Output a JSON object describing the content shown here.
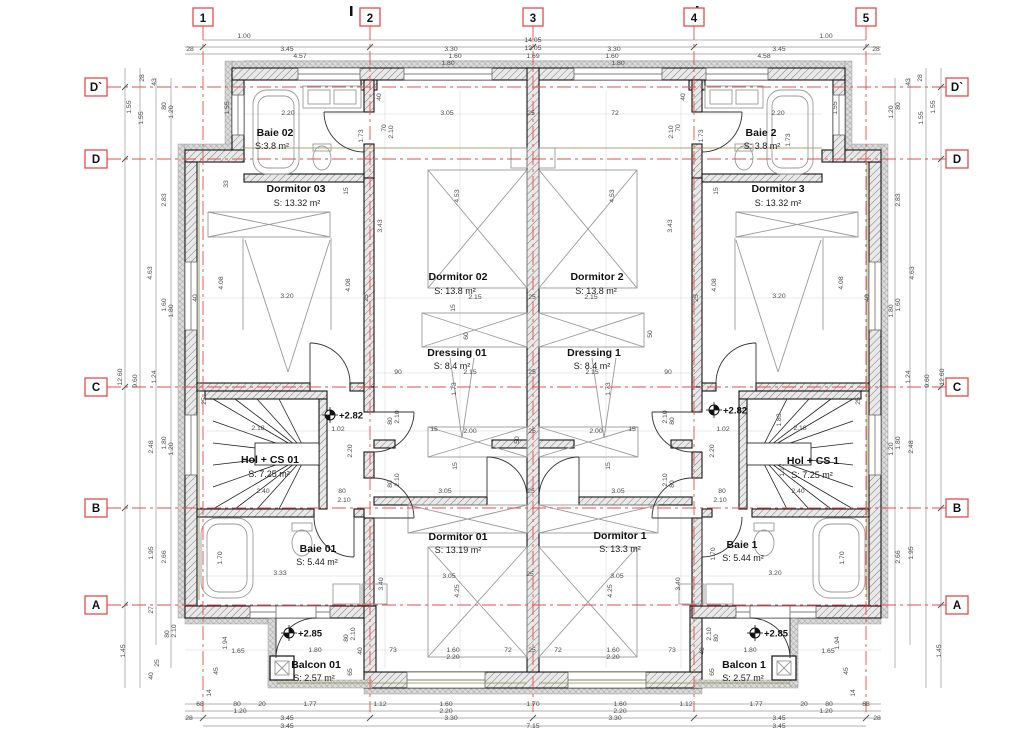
{
  "drawing": {
    "type": "floor-plan",
    "units": "m"
  },
  "colors": {
    "grid_red": "#e64c4c",
    "wall": "#141414",
    "dim_text": "#4a4a4a",
    "olive_line": "#8d8d3a"
  },
  "grid": {
    "cols": [
      {
        "label": "1",
        "x": 203
      },
      {
        "label": "2",
        "x": 370
      },
      {
        "label": "3",
        "x": 533
      },
      {
        "label": "4",
        "x": 694
      },
      {
        "label": "5",
        "x": 866
      }
    ],
    "rows": [
      {
        "label": "D`",
        "y": 87
      },
      {
        "label": "D",
        "y": 159
      },
      {
        "label": "C",
        "y": 387
      },
      {
        "label": "B",
        "y": 508
      },
      {
        "label": "A",
        "y": 605
      }
    ]
  },
  "rooms": [
    {
      "name": "Baie 02",
      "area": "S:3.8 m²",
      "nx": 275,
      "ny": 136,
      "ax": 272,
      "ay": 149
    },
    {
      "name": "Dormitor 03",
      "area": "S: 13.32 m²",
      "nx": 296,
      "ny": 192,
      "ax": 297,
      "ay": 206
    },
    {
      "name": "Baie 2",
      "area": "S: 3.8 m²",
      "nx": 761,
      "ny": 136,
      "ax": 762,
      "ay": 149
    },
    {
      "name": "Dormitor 3",
      "area": "S: 13.32 m²",
      "nx": 778,
      "ny": 192,
      "ax": 778,
      "ay": 206
    },
    {
      "name": "Dormitor 02",
      "area": "S: 13.8 m²",
      "nx": 458,
      "ny": 280,
      "ax": 455,
      "ay": 294
    },
    {
      "name": "Dormitor 2",
      "area": "S: 13.8 m²",
      "nx": 597,
      "ny": 280,
      "ax": 596,
      "ay": 294
    },
    {
      "name": "Dressing 01",
      "area": "S: 8.4 m²",
      "nx": 457,
      "ny": 356,
      "ax": 452,
      "ay": 369
    },
    {
      "name": "Dressing 1",
      "area": "S: 8.4 m²",
      "nx": 594,
      "ny": 356,
      "ax": 592,
      "ay": 369
    },
    {
      "name": "Hol + CS 01",
      "area": "S: 7.25 m²",
      "nx": 270,
      "ny": 463,
      "ax": 269,
      "ay": 477
    },
    {
      "name": "Hol + CS 1",
      "area": "S: 7.25 m²",
      "nx": 813,
      "ny": 464,
      "ax": 812,
      "ay": 478
    },
    {
      "name": "Baie 01",
      "area": "S: 5.44 m²",
      "nx": 318,
      "ny": 552,
      "ax": 317,
      "ay": 565
    },
    {
      "name": "Baie 1",
      "area": "S: 5.44 m²",
      "nx": 742,
      "ny": 548,
      "ax": 743,
      "ay": 561
    },
    {
      "name": "Dormitor 01",
      "area": "S: 13.19 m²",
      "nx": 458,
      "ny": 540,
      "ax": 458,
      "ay": 553
    },
    {
      "name": "Dormitor 1",
      "area": "S: 13.3 m²",
      "nx": 620,
      "ny": 539,
      "ax": 620,
      "ay": 552
    },
    {
      "name": "Balcon 01",
      "area": "S: 2.57 m²",
      "nx": 316,
      "ny": 668,
      "ax": 314,
      "ay": 681
    },
    {
      "name": "Balcon 1",
      "area": "S: 2.57 m²",
      "nx": 744,
      "ny": 668,
      "ax": 743,
      "ay": 681
    }
  ],
  "elevations": [
    {
      "label": "+2.82",
      "x": 330,
      "y": 415
    },
    {
      "label": "+2.82",
      "x": 714,
      "y": 410
    },
    {
      "label": "+2.85",
      "x": 289,
      "y": 633
    },
    {
      "label": "+2.85",
      "x": 755,
      "y": 633
    }
  ],
  "dims": [
    {
      "t": "14.05",
      "x": 533,
      "y": 42
    },
    {
      "t": "12.05",
      "x": 533,
      "y": 50
    },
    {
      "t": "1.00",
      "x": 244,
      "y": 38
    },
    {
      "t": "1.00",
      "x": 826,
      "y": 38
    },
    {
      "t": "28",
      "x": 190,
      "y": 51
    },
    {
      "t": "3.45",
      "x": 287,
      "y": 51
    },
    {
      "t": "3.30",
      "x": 451,
      "y": 51
    },
    {
      "t": "3.30",
      "x": 614,
      "y": 51
    },
    {
      "t": "3.45",
      "x": 779,
      "y": 51
    },
    {
      "t": "28",
      "x": 876,
      "y": 51
    },
    {
      "t": "4.57",
      "x": 300,
      "y": 58
    },
    {
      "t": "1.60",
      "x": 455,
      "y": 58
    },
    {
      "t": "1.69",
      "x": 533,
      "y": 58
    },
    {
      "t": "1.60",
      "x": 612,
      "y": 58
    },
    {
      "t": "4.58",
      "x": 764,
      "y": 58
    },
    {
      "t": "1.80",
      "x": 448,
      "y": 65
    },
    {
      "t": "1.80",
      "x": 618,
      "y": 65
    },
    {
      "t": "28",
      "x": 144,
      "y": 78,
      "r": 1
    },
    {
      "t": "43",
      "x": 156,
      "y": 82,
      "r": 1
    },
    {
      "t": "1.55",
      "x": 131,
      "y": 107,
      "r": 1
    },
    {
      "t": "1.55",
      "x": 143,
      "y": 118,
      "r": 1
    },
    {
      "t": "80",
      "x": 166,
      "y": 106,
      "r": 1
    },
    {
      "t": "1.20",
      "x": 173,
      "y": 112,
      "r": 1
    },
    {
      "t": "1.55",
      "x": 229,
      "y": 108,
      "r": 1
    },
    {
      "t": "33",
      "x": 228,
      "y": 184,
      "r": 1
    },
    {
      "t": "2.83",
      "x": 166,
      "y": 200,
      "r": 1
    },
    {
      "t": "4.63",
      "x": 152,
      "y": 273,
      "r": 1
    },
    {
      "t": "1.60",
      "x": 166,
      "y": 305,
      "r": 1
    },
    {
      "t": "1.80",
      "x": 173,
      "y": 311,
      "r": 1
    },
    {
      "t": "4.08",
      "x": 223,
      "y": 283,
      "r": 1
    },
    {
      "t": "4.08",
      "x": 350,
      "y": 285,
      "r": 1
    },
    {
      "t": "40",
      "x": 197,
      "y": 298,
      "r": 1
    },
    {
      "t": "25",
      "x": 368,
      "y": 298,
      "r": 1
    },
    {
      "t": "1.24",
      "x": 156,
      "y": 377,
      "r": 1
    },
    {
      "t": "9.60",
      "x": 137,
      "y": 381,
      "r": 1
    },
    {
      "t": "12.60",
      "x": 122,
      "y": 377,
      "r": 1
    },
    {
      "t": "2.48",
      "x": 153,
      "y": 447,
      "r": 1
    },
    {
      "t": "1.80",
      "x": 166,
      "y": 443,
      "r": 1
    },
    {
      "t": "1.20",
      "x": 173,
      "y": 449,
      "r": 1
    },
    {
      "t": "1.95",
      "x": 153,
      "y": 553,
      "r": 1
    },
    {
      "t": "2.66",
      "x": 166,
      "y": 557,
      "r": 1
    },
    {
      "t": "27",
      "x": 153,
      "y": 610,
      "r": 1
    },
    {
      "t": "80",
      "x": 169,
      "y": 634,
      "r": 1
    },
    {
      "t": "2.10",
      "x": 176,
      "y": 631,
      "r": 1
    },
    {
      "t": "1.45",
      "x": 125,
      "y": 651,
      "r": 1
    },
    {
      "t": "40",
      "x": 153,
      "y": 676,
      "r": 1
    },
    {
      "t": "25",
      "x": 159,
      "y": 663,
      "r": 1
    },
    {
      "t": "1.94",
      "x": 227,
      "y": 643,
      "r": 1
    },
    {
      "t": "1.65",
      "x": 238,
      "y": 653
    },
    {
      "t": "45",
      "x": 218,
      "y": 671,
      "r": 1
    },
    {
      "t": "14",
      "x": 211,
      "y": 693,
      "r": 1
    },
    {
      "t": "28",
      "x": 922,
      "y": 78,
      "r": 1
    },
    {
      "t": "43",
      "x": 910,
      "y": 82,
      "r": 1
    },
    {
      "t": "1.55",
      "x": 935,
      "y": 107,
      "r": 1
    },
    {
      "t": "1.55",
      "x": 923,
      "y": 118,
      "r": 1
    },
    {
      "t": "80",
      "x": 900,
      "y": 106,
      "r": 1
    },
    {
      "t": "1.20",
      "x": 893,
      "y": 112,
      "r": 1
    },
    {
      "t": "1.55",
      "x": 837,
      "y": 108,
      "r": 1
    },
    {
      "t": "2.83",
      "x": 900,
      "y": 200,
      "r": 1
    },
    {
      "t": "4.63",
      "x": 914,
      "y": 273,
      "r": 1
    },
    {
      "t": "1.60",
      "x": 900,
      "y": 305,
      "r": 1
    },
    {
      "t": "1.80",
      "x": 893,
      "y": 311,
      "r": 1
    },
    {
      "t": "4.08",
      "x": 843,
      "y": 283,
      "r": 1
    },
    {
      "t": "4.08",
      "x": 716,
      "y": 285,
      "r": 1
    },
    {
      "t": "40",
      "x": 869,
      "y": 298,
      "r": 1
    },
    {
      "t": "25",
      "x": 698,
      "y": 298,
      "r": 1
    },
    {
      "t": "1.24",
      "x": 910,
      "y": 377,
      "r": 1
    },
    {
      "t": "9.60",
      "x": 929,
      "y": 381,
      "r": 1
    },
    {
      "t": "12.60",
      "x": 944,
      "y": 377,
      "r": 1
    },
    {
      "t": "2.48",
      "x": 913,
      "y": 447,
      "r": 1
    },
    {
      "t": "1.80",
      "x": 900,
      "y": 443,
      "r": 1
    },
    {
      "t": "1.20",
      "x": 893,
      "y": 449,
      "r": 1
    },
    {
      "t": "1.95",
      "x": 913,
      "y": 553,
      "r": 1
    },
    {
      "t": "2.66",
      "x": 900,
      "y": 557,
      "r": 1
    },
    {
      "t": "1.45",
      "x": 941,
      "y": 651,
      "r": 1
    },
    {
      "t": "1.94",
      "x": 839,
      "y": 643,
      "r": 1
    },
    {
      "t": "1.65",
      "x": 828,
      "y": 653
    },
    {
      "t": "45",
      "x": 848,
      "y": 671,
      "r": 1
    },
    {
      "t": "14",
      "x": 855,
      "y": 693,
      "r": 1
    },
    {
      "t": "68",
      "x": 200,
      "y": 706
    },
    {
      "t": "80",
      "x": 237,
      "y": 706
    },
    {
      "t": "1.20",
      "x": 240,
      "y": 713
    },
    {
      "t": "20",
      "x": 262,
      "y": 706
    },
    {
      "t": "1.77",
      "x": 310,
      "y": 706
    },
    {
      "t": "1.12",
      "x": 380,
      "y": 706
    },
    {
      "t": "1.60",
      "x": 446,
      "y": 706
    },
    {
      "t": "2.20",
      "x": 446,
      "y": 713
    },
    {
      "t": "1.70",
      "x": 533,
      "y": 706
    },
    {
      "t": "1.60",
      "x": 620,
      "y": 706
    },
    {
      "t": "2.20",
      "x": 620,
      "y": 713
    },
    {
      "t": "1.12",
      "x": 686,
      "y": 706
    },
    {
      "t": "1.77",
      "x": 756,
      "y": 706
    },
    {
      "t": "20",
      "x": 804,
      "y": 706
    },
    {
      "t": "80",
      "x": 829,
      "y": 706
    },
    {
      "t": "1.20",
      "x": 826,
      "y": 713
    },
    {
      "t": "68",
      "x": 866,
      "y": 706
    },
    {
      "t": "28",
      "x": 189,
      "y": 720
    },
    {
      "t": "3.45",
      "x": 287,
      "y": 720
    },
    {
      "t": "3.30",
      "x": 451,
      "y": 720
    },
    {
      "t": "3.30",
      "x": 615,
      "y": 720
    },
    {
      "t": "3.45",
      "x": 779,
      "y": 720
    },
    {
      "t": "28",
      "x": 877,
      "y": 720
    },
    {
      "t": "3.45",
      "x": 287,
      "y": 728
    },
    {
      "t": "7.15",
      "x": 533,
      "y": 728
    },
    {
      "t": "3.45",
      "x": 779,
      "y": 728
    },
    {
      "t": "2.20",
      "x": 288,
      "y": 115
    },
    {
      "t": "1.73",
      "x": 363,
      "y": 136,
      "r": 1
    },
    {
      "t": "40",
      "x": 381,
      "y": 97,
      "r": 1
    },
    {
      "t": "70",
      "x": 386,
      "y": 128,
      "r": 1
    },
    {
      "t": "2.10",
      "x": 393,
      "y": 132,
      "r": 1
    },
    {
      "t": "3.05",
      "x": 447,
      "y": 115
    },
    {
      "t": "25",
      "x": 531,
      "y": 115
    },
    {
      "t": "72",
      "x": 615,
      "y": 115
    },
    {
      "t": "70",
      "x": 680,
      "y": 128,
      "r": 1
    },
    {
      "t": "2.10",
      "x": 673,
      "y": 132,
      "r": 1
    },
    {
      "t": "40",
      "x": 685,
      "y": 97,
      "r": 1
    },
    {
      "t": "2.20",
      "x": 778,
      "y": 115
    },
    {
      "t": "1.73",
      "x": 703,
      "y": 136,
      "r": 1
    },
    {
      "t": "1.73",
      "x": 790,
      "y": 140,
      "r": 1
    },
    {
      "t": "15",
      "x": 348,
      "y": 191,
      "r": 1
    },
    {
      "t": "15",
      "x": 718,
      "y": 191,
      "r": 1
    },
    {
      "t": "4.53",
      "x": 459,
      "y": 196,
      "r": 1
    },
    {
      "t": "4.53",
      "x": 614,
      "y": 196,
      "r": 1
    },
    {
      "t": "3.43",
      "x": 382,
      "y": 226,
      "r": 1
    },
    {
      "t": "3.43",
      "x": 672,
      "y": 226,
      "r": 1
    },
    {
      "t": "3.20",
      "x": 287,
      "y": 298
    },
    {
      "t": "3.20",
      "x": 779,
      "y": 298
    },
    {
      "t": "2.15",
      "x": 475,
      "y": 299
    },
    {
      "t": "25",
      "x": 532,
      "y": 299
    },
    {
      "t": "2.15",
      "x": 591,
      "y": 299
    },
    {
      "t": "15",
      "x": 455,
      "y": 308,
      "r": 1
    },
    {
      "t": "60",
      "x": 468,
      "y": 336,
      "r": 1
    },
    {
      "t": "50",
      "x": 652,
      "y": 334,
      "r": 1
    },
    {
      "t": "90",
      "x": 398,
      "y": 374
    },
    {
      "t": "2.15",
      "x": 470,
      "y": 374
    },
    {
      "t": "25",
      "x": 532,
      "y": 374
    },
    {
      "t": "2.15",
      "x": 592,
      "y": 374
    },
    {
      "t": "90",
      "x": 668,
      "y": 374
    },
    {
      "t": "1.73",
      "x": 456,
      "y": 389,
      "r": 1
    },
    {
      "t": "1.73",
      "x": 610,
      "y": 389,
      "r": 1
    },
    {
      "t": "15",
      "x": 434,
      "y": 431
    },
    {
      "t": "2.00",
      "x": 470,
      "y": 433
    },
    {
      "t": "25",
      "x": 532,
      "y": 433
    },
    {
      "t": "2.00",
      "x": 596,
      "y": 433
    },
    {
      "t": "15",
      "x": 632,
      "y": 431
    },
    {
      "t": "50",
      "x": 519,
      "y": 440,
      "r": 1
    },
    {
      "t": "15",
      "x": 457,
      "y": 466,
      "r": 1
    },
    {
      "t": "15",
      "x": 610,
      "y": 466,
      "r": 1
    },
    {
      "t": "2.18",
      "x": 258,
      "y": 430
    },
    {
      "t": "1.02",
      "x": 338,
      "y": 431
    },
    {
      "t": "2.20",
      "x": 352,
      "y": 451,
      "r": 1
    },
    {
      "t": "2.40",
      "x": 263,
      "y": 493
    },
    {
      "t": "80",
      "x": 342,
      "y": 493
    },
    {
      "t": "2.10",
      "x": 344,
      "y": 502
    },
    {
      "t": "2.18",
      "x": 800,
      "y": 430
    },
    {
      "t": "1.02",
      "x": 723,
      "y": 431
    },
    {
      "t": "2.20",
      "x": 714,
      "y": 451,
      "r": 1
    },
    {
      "t": "1.83",
      "x": 781,
      "y": 420,
      "r": 1
    },
    {
      "t": "1.17",
      "x": 784,
      "y": 470,
      "r": 1
    },
    {
      "t": "2.40",
      "x": 798,
      "y": 493
    },
    {
      "t": "80",
      "x": 722,
      "y": 493
    },
    {
      "t": "2.10",
      "x": 720,
      "y": 502
    },
    {
      "t": "80",
      "x": 392,
      "y": 421,
      "r": 1
    },
    {
      "t": "2.10",
      "x": 399,
      "y": 417,
      "r": 1
    },
    {
      "t": "80",
      "x": 392,
      "y": 484,
      "r": 1
    },
    {
      "t": "2.10",
      "x": 399,
      "y": 480,
      "r": 1
    },
    {
      "t": "80",
      "x": 674,
      "y": 421,
      "r": 1
    },
    {
      "t": "2.10",
      "x": 667,
      "y": 417,
      "r": 1
    },
    {
      "t": "80",
      "x": 674,
      "y": 484,
      "r": 1
    },
    {
      "t": "2.10",
      "x": 667,
      "y": 480,
      "r": 1
    },
    {
      "t": "25",
      "x": 206,
      "y": 401,
      "r": 1
    },
    {
      "t": "25",
      "x": 860,
      "y": 401,
      "r": 1
    },
    {
      "t": "3.05",
      "x": 445,
      "y": 493
    },
    {
      "t": "25",
      "x": 531,
      "y": 493
    },
    {
      "t": "3.05",
      "x": 618,
      "y": 493
    },
    {
      "t": "3.05",
      "x": 449,
      "y": 578
    },
    {
      "t": "25",
      "x": 530,
      "y": 576
    },
    {
      "t": "3.05",
      "x": 617,
      "y": 578
    },
    {
      "t": "4.25",
      "x": 459,
      "y": 591,
      "r": 1
    },
    {
      "t": "4.25",
      "x": 612,
      "y": 591,
      "r": 1
    },
    {
      "t": "3.40",
      "x": 383,
      "y": 584,
      "r": 1
    },
    {
      "t": "3.40",
      "x": 680,
      "y": 584,
      "r": 1
    },
    {
      "t": "1.70",
      "x": 222,
      "y": 558,
      "r": 1
    },
    {
      "t": "3.33",
      "x": 280,
      "y": 575
    },
    {
      "t": "1.70",
      "x": 844,
      "y": 558,
      "r": 1
    },
    {
      "t": "3.20",
      "x": 775,
      "y": 575
    },
    {
      "t": "1.70",
      "x": 715,
      "y": 554,
      "r": 1
    },
    {
      "t": "1.80",
      "x": 315,
      "y": 652
    },
    {
      "t": "1.80",
      "x": 750,
      "y": 652
    },
    {
      "t": "73",
      "x": 393,
      "y": 652
    },
    {
      "t": "1.60",
      "x": 453,
      "y": 652
    },
    {
      "t": "2.20",
      "x": 453,
      "y": 659
    },
    {
      "t": "72",
      "x": 508,
      "y": 652
    },
    {
      "t": "25",
      "x": 532,
      "y": 652
    },
    {
      "t": "72",
      "x": 558,
      "y": 652
    },
    {
      "t": "1.60",
      "x": 613,
      "y": 652
    },
    {
      "t": "2.20",
      "x": 613,
      "y": 659
    },
    {
      "t": "73",
      "x": 672,
      "y": 652
    },
    {
      "t": "80",
      "x": 348,
      "y": 638,
      "r": 1
    },
    {
      "t": "2.10",
      "x": 355,
      "y": 634,
      "r": 1
    },
    {
      "t": "80",
      "x": 718,
      "y": 638,
      "r": 1
    },
    {
      "t": "2.10",
      "x": 711,
      "y": 634,
      "r": 1
    },
    {
      "t": "40",
      "x": 362,
      "y": 651,
      "r": 1
    },
    {
      "t": "40",
      "x": 704,
      "y": 651,
      "r": 1
    },
    {
      "t": "65",
      "x": 352,
      "y": 672,
      "r": 1
    },
    {
      "t": "65",
      "x": 714,
      "y": 672,
      "r": 1
    }
  ]
}
